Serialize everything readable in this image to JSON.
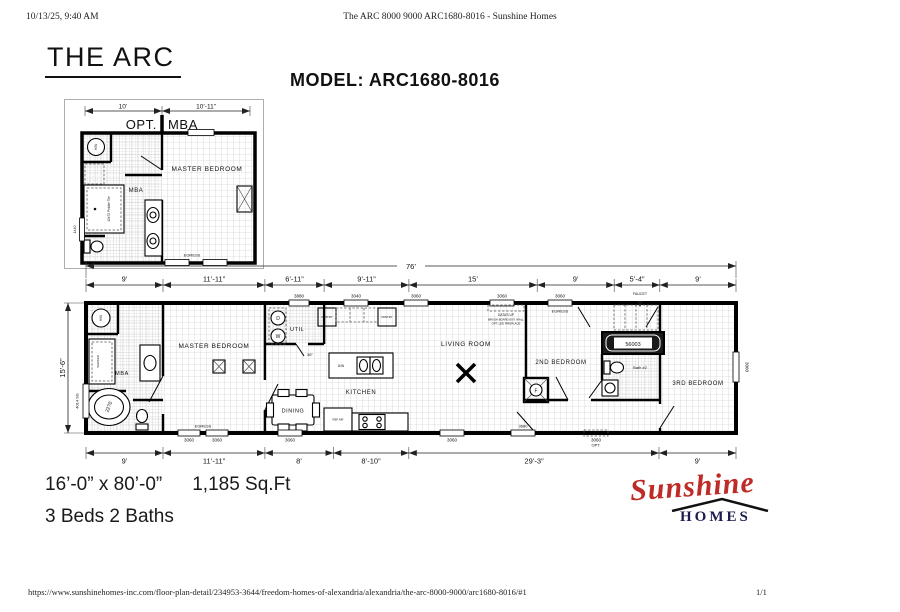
{
  "print_header": {
    "timestamp": "10/13/25, 9:40 AM",
    "doc_title": "The ARC 8000 9000 ARC1680-8016 - Sunshine Homes"
  },
  "print_footer": {
    "url": "https://www.sunshinehomes-inc.com/floor-plan-detail/234953-3644/freedom-homes-of-alexandria/alexandria/the-arc-8000-9000/arc1680-8016/#1",
    "page_number": "1/1"
  },
  "heading": {
    "plan_name": "THE ARC",
    "model": "MODEL: ARC1680-8016"
  },
  "specs": {
    "size": "16’-0” x 80’-0”",
    "area": "1,185 Sq.Ft",
    "beds_baths": "3 Beds 2 Baths"
  },
  "logo": {
    "brand": "Sunshine",
    "sub_brand": "HOMES"
  },
  "opt_plan": {
    "dims": {
      "left": "10’",
      "right": "10’-11”"
    },
    "title": {
      "opt": "OPT.",
      "mba": "MBA"
    },
    "labels": {
      "master_bedroom": "MASTER BEDROOM",
      "mba": "MBA",
      "hw": "H/W",
      "pebble_tile": "42x72 Pebble Tile",
      "window_tag": "1440",
      "egress": "EGRESS"
    }
  },
  "main_plan": {
    "overall_width": "76’",
    "overall_height": "15’-6”",
    "top_dims": [
      "9’",
      "11’-11”",
      "6’-11”",
      "9’-11”",
      "15’",
      "9’",
      "5’-4”",
      "9’"
    ],
    "bottom_dims": [
      "9’",
      "11’-11”",
      "8’",
      "8’-10”",
      "29’-3”",
      "9’"
    ],
    "rooms": {
      "master_bedroom": "MASTER BEDROOM",
      "mba": "MBA",
      "util": "UTIL",
      "kitchen": "KITCHEN",
      "dining": "DINING",
      "living_room": "LIVING ROOM",
      "second_bedroom": "2ND BEDROOM",
      "bath2": "Bath #2",
      "third_bedroom": "3RD BEDROOM"
    },
    "appliances": {
      "hw": "H/W",
      "dryer": "D",
      "washer": "W",
      "furnace": "F",
      "dishwasher": "D/W",
      "fridge": "REF AIR",
      "pantry_left": "PANTRY",
      "pantry_right": "PANTRY",
      "tub_master": "2270",
      "tub_bath2": "56003"
    },
    "window_tags": {
      "door_util": "3880",
      "top_1": "3040",
      "top_2": "3060",
      "top_3": "3060",
      "top_4": "3060",
      "egress_top": "EGRESS",
      "faucet": "FAUCET",
      "left_vert": "4014 SG",
      "right_vert": "3060",
      "bottom_1": "3060",
      "bottom_2": "3060",
      "egress_bottom": "EGRESS",
      "bottom_3": "3060",
      "bottom_4": "3060",
      "door_front": "3680",
      "bottom_opt_size": "3060",
      "bottom_opt": "OPT.",
      "door_note": "36”"
    },
    "notes": {
      "media_1": "DATA’S UP",
      "media_2": "BRUSH BOARD ENT. WALL",
      "media_3": "OPT. LED FIREPLACE",
      "shower": "SHOWER"
    }
  }
}
